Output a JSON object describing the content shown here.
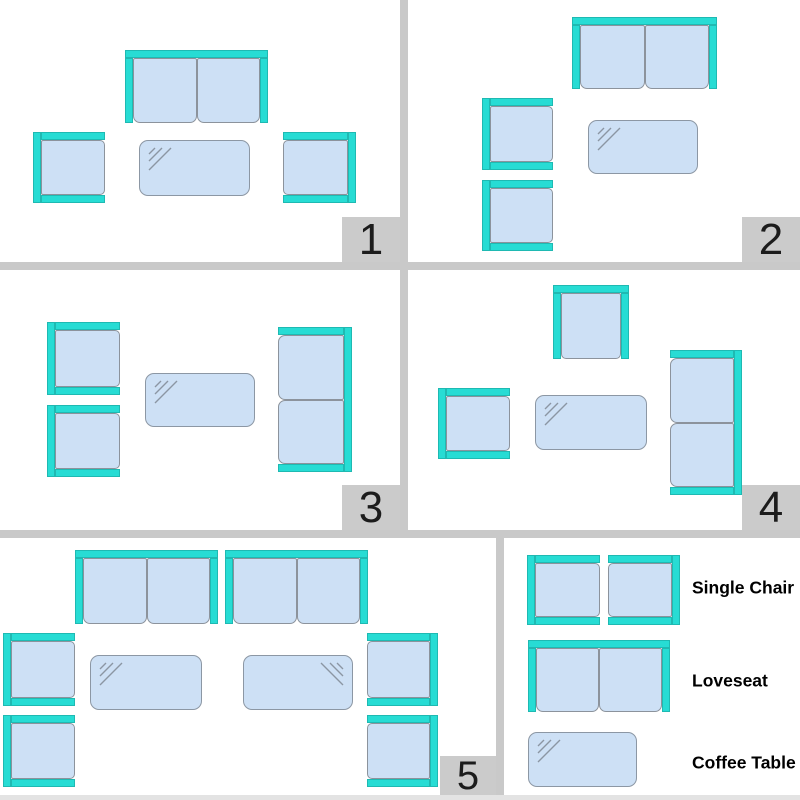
{
  "colors": {
    "teal": "#27DCD4",
    "teal_border": "#1FB9B2",
    "cushion": "#CDE0F5",
    "cushion_border": "#8C939C",
    "table_border": "#8C97A4",
    "shine": "#8B96A3",
    "divider": "#C9C9C9",
    "badge_bg": "#CBCBCB",
    "badge_text": "#1C1C1C",
    "bottom_strip": "#E3E3E3"
  },
  "panels": [
    {
      "number": "1",
      "box": {
        "x": 0,
        "y": 0,
        "w": 400,
        "h": 262
      },
      "furniture": [
        {
          "type": "loveseat",
          "facing": "down",
          "x": 125,
          "y": 50,
          "w": 143,
          "h": 73
        },
        {
          "type": "chair",
          "facing": "right",
          "x": 33,
          "y": 132,
          "w": 72,
          "h": 71
        },
        {
          "type": "table",
          "shine": "tl",
          "x": 139,
          "y": 140,
          "w": 111,
          "h": 56
        },
        {
          "type": "chair",
          "facing": "left",
          "x": 283,
          "y": 132,
          "w": 73,
          "h": 71
        }
      ]
    },
    {
      "number": "2",
      "box": {
        "x": 408,
        "y": 0,
        "w": 392,
        "h": 262
      },
      "furniture": [
        {
          "type": "loveseat",
          "facing": "down",
          "x": 164,
          "y": 17,
          "w": 145,
          "h": 72
        },
        {
          "type": "chair",
          "facing": "right",
          "x": 74,
          "y": 98,
          "w": 71,
          "h": 72
        },
        {
          "type": "table",
          "shine": "tl",
          "x": 180,
          "y": 120,
          "w": 110,
          "h": 54
        },
        {
          "type": "chair",
          "facing": "right",
          "x": 74,
          "y": 180,
          "w": 71,
          "h": 71
        }
      ]
    },
    {
      "number": "3",
      "box": {
        "x": 0,
        "y": 270,
        "w": 400,
        "h": 260
      },
      "furniture": [
        {
          "type": "chair",
          "facing": "right",
          "x": 47,
          "y": 52,
          "w": 73,
          "h": 73
        },
        {
          "type": "chair",
          "facing": "right",
          "x": 47,
          "y": 135,
          "w": 73,
          "h": 72
        },
        {
          "type": "table",
          "shine": "tl",
          "x": 145,
          "y": 103,
          "w": 110,
          "h": 54
        },
        {
          "type": "loveseat",
          "facing": "left",
          "x": 278,
          "y": 57,
          "w": 74,
          "h": 145
        }
      ]
    },
    {
      "number": "4",
      "box": {
        "x": 408,
        "y": 270,
        "w": 392,
        "h": 260
      },
      "furniture": [
        {
          "type": "chair",
          "facing": "down",
          "x": 145,
          "y": 15,
          "w": 76,
          "h": 74
        },
        {
          "type": "chair",
          "facing": "right",
          "x": 30,
          "y": 118,
          "w": 72,
          "h": 71
        },
        {
          "type": "table",
          "shine": "tl",
          "x": 127,
          "y": 125,
          "w": 112,
          "h": 55
        },
        {
          "type": "loveseat",
          "facing": "left",
          "x": 262,
          "y": 80,
          "w": 72,
          "h": 145
        }
      ]
    },
    {
      "number": "5",
      "box": {
        "x": 0,
        "y": 538,
        "w": 496,
        "h": 257
      },
      "furniture": [
        {
          "type": "loveseat",
          "facing": "down",
          "x": 75,
          "y": 12,
          "w": 143,
          "h": 74
        },
        {
          "type": "loveseat",
          "facing": "down",
          "x": 225,
          "y": 12,
          "w": 143,
          "h": 74
        },
        {
          "type": "chair",
          "facing": "right",
          "x": 3,
          "y": 95,
          "w": 72,
          "h": 73
        },
        {
          "type": "chair",
          "facing": "right",
          "x": 3,
          "y": 177,
          "w": 72,
          "h": 72
        },
        {
          "type": "table",
          "shine": "tl",
          "x": 90,
          "y": 117,
          "w": 112,
          "h": 55
        },
        {
          "type": "table",
          "shine": "tr",
          "x": 243,
          "y": 117,
          "w": 110,
          "h": 55
        },
        {
          "type": "chair",
          "facing": "left",
          "x": 367,
          "y": 95,
          "w": 71,
          "h": 73
        },
        {
          "type": "chair",
          "facing": "left",
          "x": 367,
          "y": 177,
          "w": 71,
          "h": 72
        }
      ]
    }
  ],
  "legend": {
    "box": {
      "x": 504,
      "y": 538,
      "w": 296,
      "h": 257
    },
    "furniture": [
      {
        "type": "chair",
        "facing": "right",
        "x": 23,
        "y": 17,
        "w": 73,
        "h": 70
      },
      {
        "type": "chair",
        "facing": "left",
        "x": 104,
        "y": 17,
        "w": 72,
        "h": 70
      },
      {
        "type": "loveseat",
        "facing": "down",
        "x": 24,
        "y": 102,
        "w": 142,
        "h": 72
      },
      {
        "type": "table",
        "shine": "tl",
        "x": 24,
        "y": 194,
        "w": 109,
        "h": 55
      }
    ],
    "items": [
      {
        "label": "Single Chair"
      },
      {
        "label": "Loveseat"
      },
      {
        "label": "Coffee Table"
      }
    ]
  }
}
